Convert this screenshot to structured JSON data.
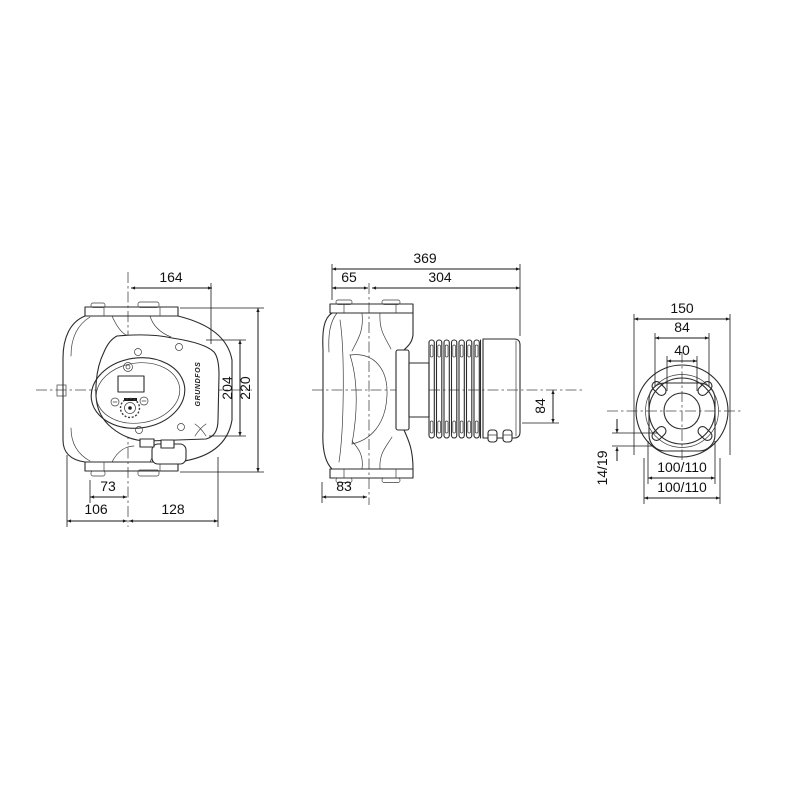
{
  "page": {
    "background": "#ffffff",
    "line_color": "#2b2b2b",
    "dimension_color": "#1a1a1a"
  },
  "front_view": {
    "dim_width_top": "164",
    "dim_height_head": "204",
    "dim_height_total": "220",
    "dim_foot_offset": "73",
    "dim_left_of_axis": "106",
    "dim_right_of_axis": "128",
    "brand_label": "GRUNDFOS"
  },
  "side_view": {
    "dim_length_total": "369",
    "dim_flange_to_axis": "65",
    "dim_axis_to_end": "304",
    "dim_axis_to_box_bottom": "84",
    "dim_body_depth": "83"
  },
  "flange_view": {
    "dim_flange_width": "150",
    "dim_bolt_span": "84",
    "dim_bore": "40",
    "dim_slot_size": "14/19",
    "dim_bolt_circle_inner": "100/110",
    "dim_bolt_circle_outer": "100/110"
  }
}
